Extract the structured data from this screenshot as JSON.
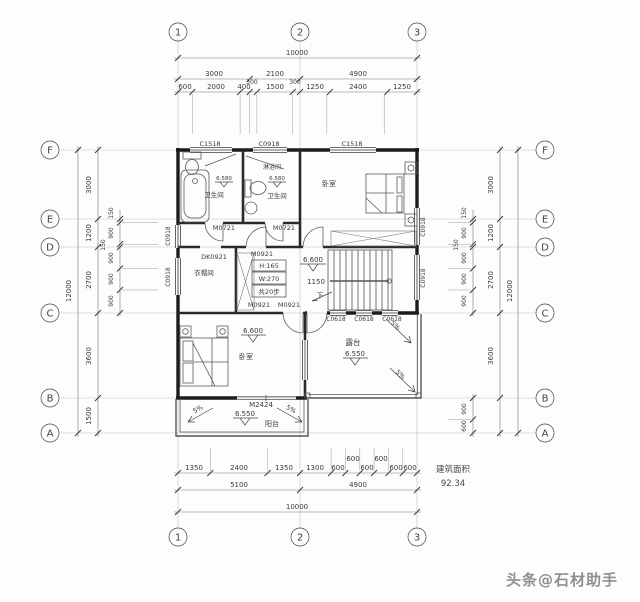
{
  "axes": {
    "cols": [
      "1",
      "2",
      "3"
    ],
    "rows": [
      "F",
      "E",
      "D",
      "C",
      "B",
      "A"
    ]
  },
  "dims": {
    "top": {
      "total": "10000",
      "mid": [
        "3000",
        "2100",
        "4900"
      ],
      "mid_small": [
        "300",
        "300"
      ],
      "fine": [
        "600",
        "2000",
        "400",
        "1500",
        "1250",
        "2400",
        "1250"
      ]
    },
    "bottom": {
      "total": "10000",
      "mid": [
        "5100",
        "4900"
      ],
      "fine": [
        "1350",
        "2400",
        "1350",
        "1300",
        "600",
        "600",
        "600",
        "600",
        "600",
        "600"
      ]
    },
    "left": {
      "total": "12000",
      "mid": [
        "3000",
        "1200",
        "2700",
        "3600",
        "1500"
      ],
      "fine": [
        "150",
        "900",
        "150",
        "900",
        "900",
        "900"
      ]
    },
    "right": {
      "total": "12000",
      "mid": [
        "3000",
        "1200",
        "2700",
        "3600"
      ],
      "fine": [
        "150",
        "900",
        "150",
        "900",
        "900",
        "900",
        "900",
        "600"
      ]
    }
  },
  "windows": {
    "top": [
      "C1518",
      "C0918",
      "C1518"
    ],
    "left": [
      "C0918",
      "C0918"
    ],
    "right": [
      "C0918",
      "C0918"
    ],
    "c_wall": [
      "C0618",
      "C0618",
      "C0618"
    ]
  },
  "doors": {
    "m0721_left": "M0721",
    "m0721_right": "M0721",
    "m0921_top": "M0921",
    "m0921_bl": "M0921",
    "m0921_br": "M0921",
    "dk0921": "DK0921",
    "m2424": "M2424"
  },
  "rooms": {
    "bath1": "卫生间",
    "shower": "淋浴间",
    "bath2": "卫生间",
    "bedroom_tr": "卧室",
    "cloak": "衣帽间",
    "bedroom_bl": "卧室",
    "terrace": "露台",
    "balcony": "阳台"
  },
  "elevations": {
    "bath1": "6.580",
    "bath2": "6.580",
    "stair": "6.600",
    "bedroom": "6.600",
    "terrace": "6.550",
    "balcony": "6.550"
  },
  "stair": {
    "h": "H:165",
    "w": "W:270",
    "steps": "共20步",
    "run": "1150",
    "down": "下"
  },
  "slopes": {
    "s1": "5%",
    "s2": "5%",
    "s3": "5%",
    "s4": "5%"
  },
  "area": {
    "label": "建筑面积",
    "value": "92.34"
  },
  "watermark": "头条@石材助手"
}
